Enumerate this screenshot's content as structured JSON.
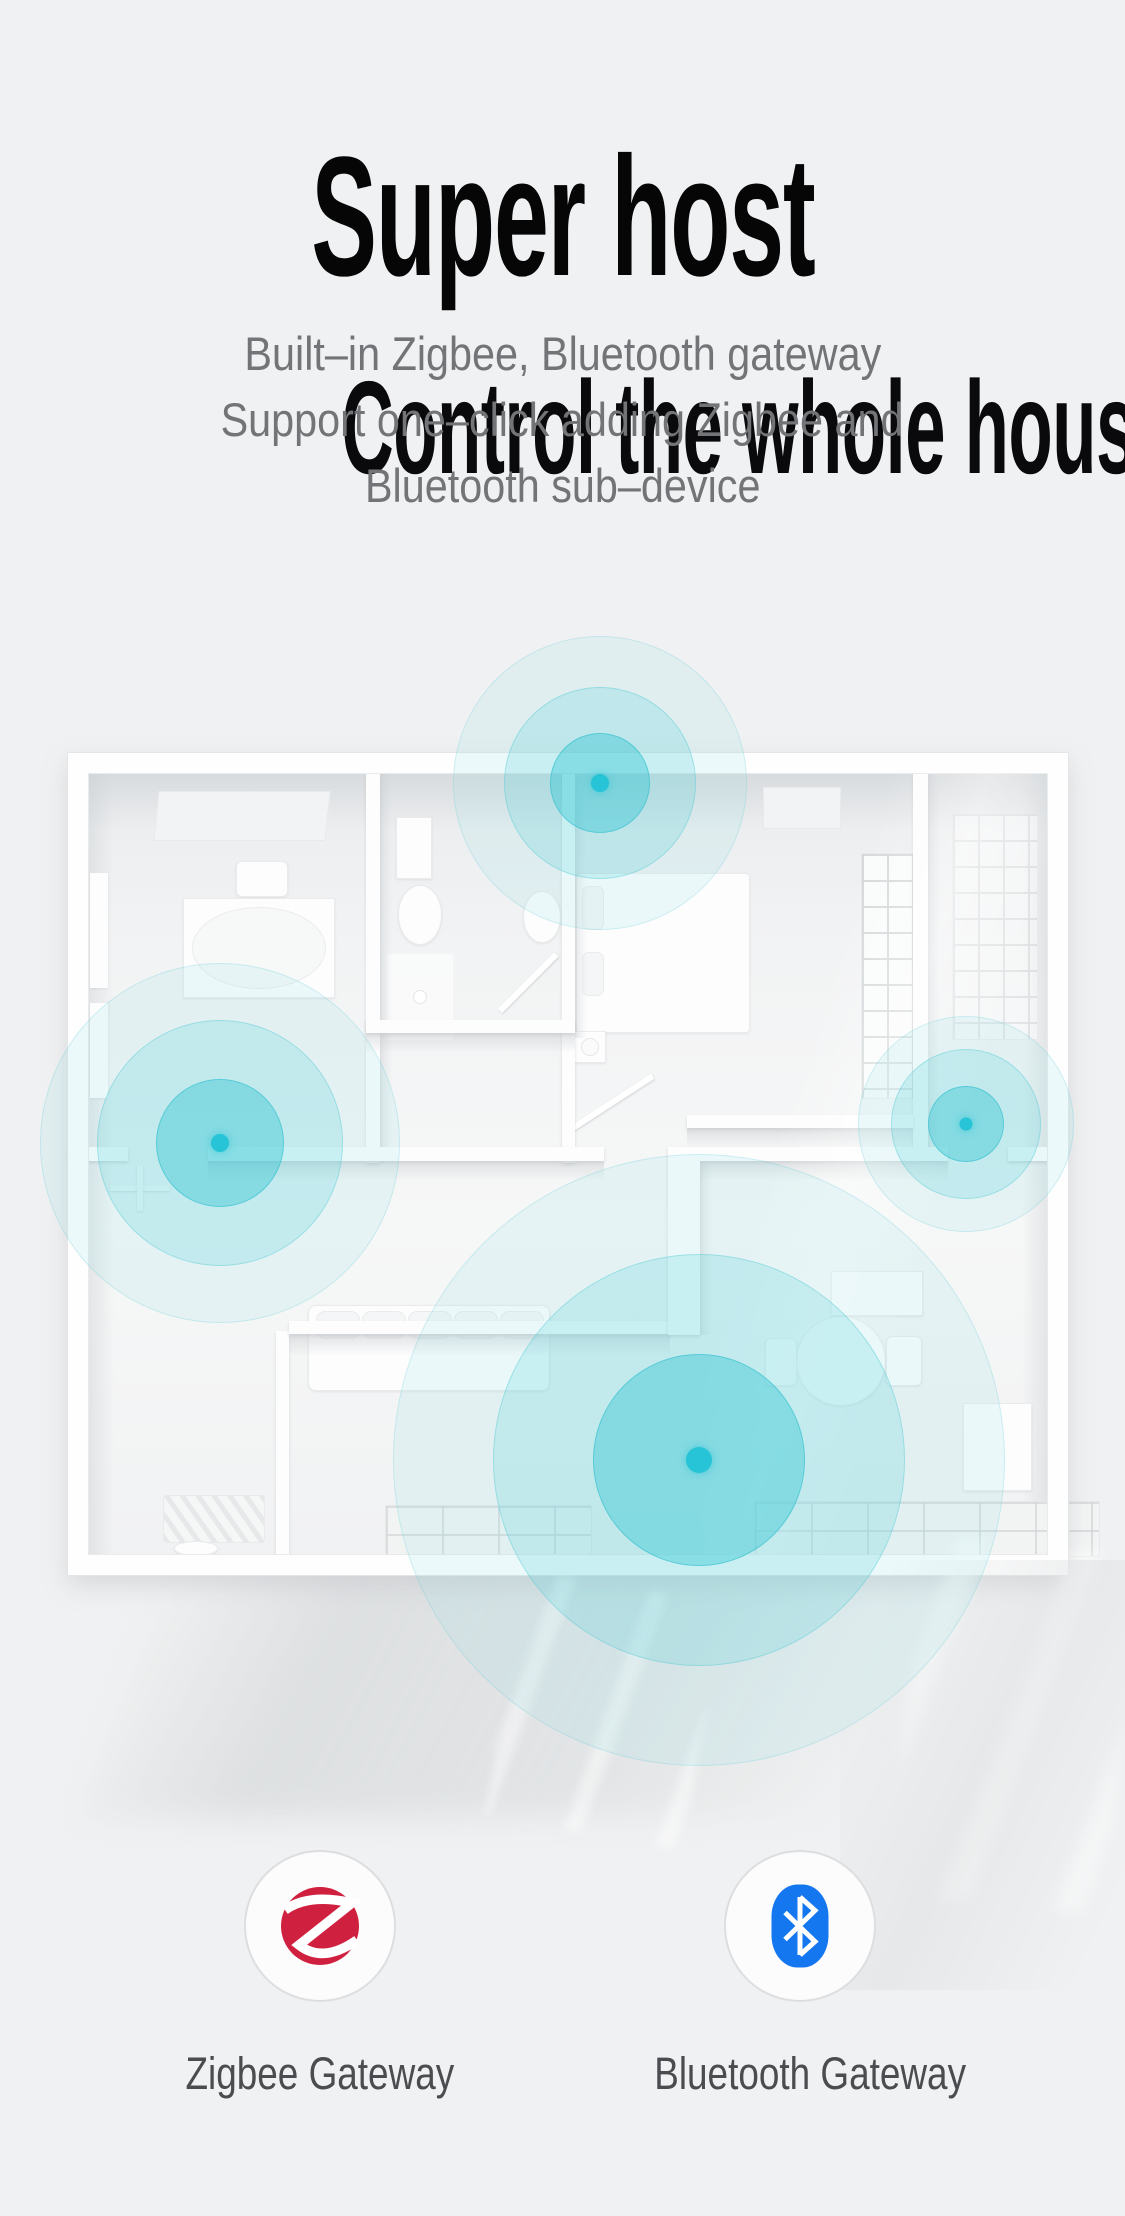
{
  "page": {
    "background_color": "#f0f1f2",
    "signal_color": "#27c3d6"
  },
  "hero": {
    "title": "Super host",
    "subtitle": "Control the whole house",
    "description_lines": [
      "Built–in Zigbee, Bluetooth gateway",
      "Support one–click adding Zigbee and",
      "Bluetooth sub–device"
    ]
  },
  "gateways": [
    {
      "label": "Zigbee Gateway",
      "icon": "zigbee-z-icon",
      "icon_color": "#d0203f"
    },
    {
      "label": "Bluetooth Gateway",
      "icon": "bluetooth-icon",
      "icon_color": "#1577f0"
    }
  ]
}
